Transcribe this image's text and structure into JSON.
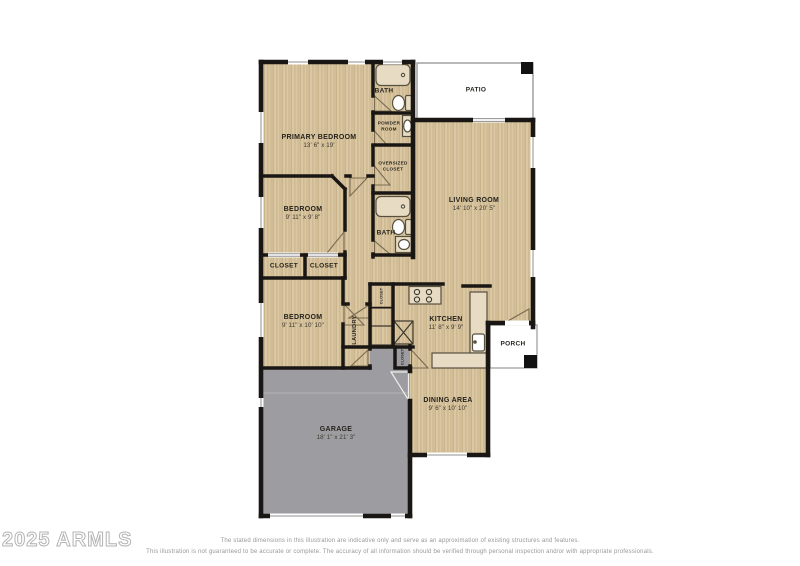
{
  "plan": {
    "rooms": {
      "primary_bedroom": {
        "label": "PRIMARY BEDROOM",
        "dims": "13' 6\" x 19'"
      },
      "bath_top": {
        "label": "BATH"
      },
      "powder_room": {
        "line1": "POWDER",
        "line2": "ROOM"
      },
      "oversized_closet": {
        "line1": "OVERSIZED",
        "line2": "CLOSET"
      },
      "bath_hall": {
        "label": "BATH"
      },
      "bedroom_middle": {
        "label": "BEDROOM",
        "dims": "9' 11\" x 9' 8\""
      },
      "closet_left": {
        "label": "CLOSET"
      },
      "closet_right": {
        "label": "CLOSET"
      },
      "bedroom_front": {
        "label": "BEDROOM",
        "dims": "9' 11\" x 10' 10\""
      },
      "laundry": {
        "label": "LAUNDRY"
      },
      "closet_hall_upper": {
        "label": "CLOSET"
      },
      "closet_entry_lower": {
        "label": "CLOSET"
      },
      "living_room": {
        "label": "LIVING ROOM",
        "dims": "14' 10\" x 20' 5\""
      },
      "patio": {
        "label": "PATIO"
      },
      "kitchen": {
        "label": "KITCHEN",
        "dims": "11' 8\" x 9' 9\""
      },
      "porch": {
        "label": "PORCH"
      },
      "dining_area": {
        "label": "DINING AREA",
        "dims": "9' 6\" x 10' 10\""
      },
      "garage": {
        "label": "GARAGE",
        "dims": "18' 1\" x 21' 3\""
      }
    }
  },
  "footer": {
    "watermark": "2025 ARMLS",
    "disclaimer_line1": "The stated dimensions in this illustration are indicative only and serve as an approximation of existing structures and features.",
    "disclaimer_line2": "This illustration is not guaranteed to be accurate or complete. The accuracy of all information should be verified through personal inspection and/or with appropriate professionals."
  },
  "colors": {
    "wood_floor": "#d9c6a2",
    "garage_floor": "#9d9da1",
    "wall": "#191613",
    "patio": "#ffffff"
  }
}
